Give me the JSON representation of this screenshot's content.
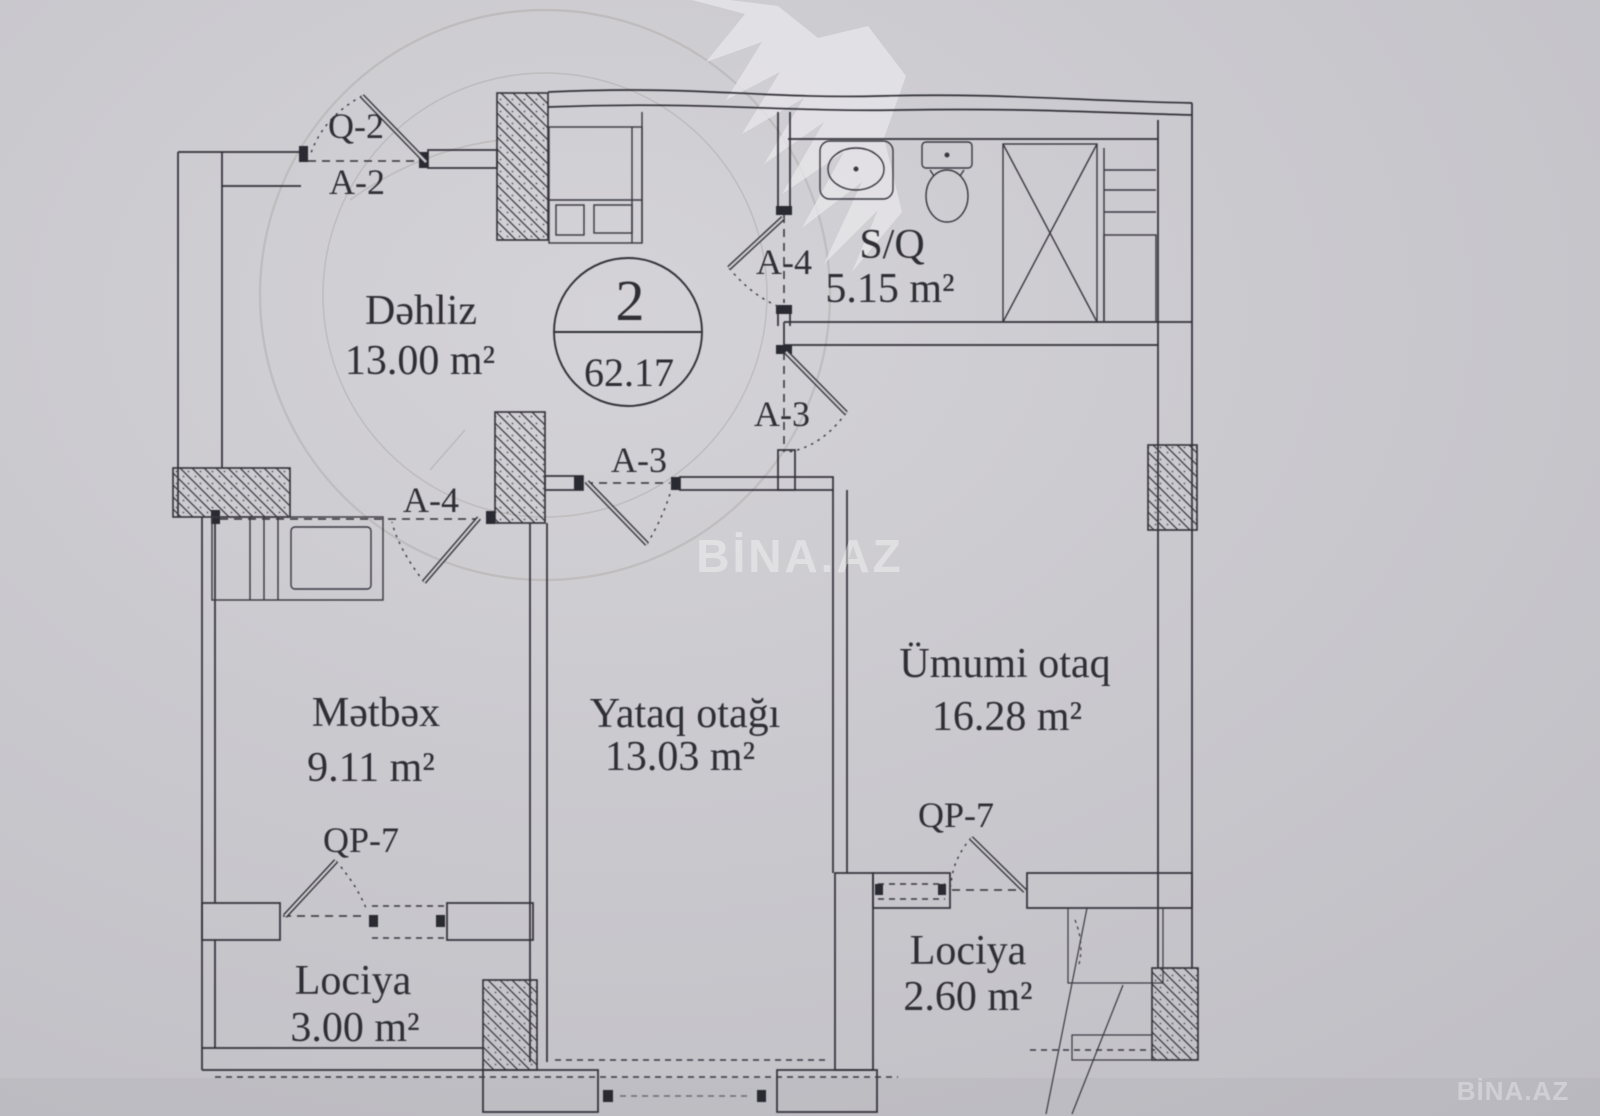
{
  "unit_badge": {
    "number": "2",
    "total_area": "62.17"
  },
  "rooms": {
    "dehliz": {
      "name": "Dəhliz",
      "area": "13.00 m²"
    },
    "sq": {
      "name": "S/Q",
      "area": "5.15 m²"
    },
    "metbex": {
      "name": "Mətbəx",
      "area": "9.11 m²"
    },
    "yataq": {
      "name": "Yataq otağı",
      "area": "13.03 m²"
    },
    "umumi": {
      "name": "Ümumi otaq",
      "area": "16.28 m²"
    },
    "lociya_left": {
      "name": "Lociya",
      "area": "3.00 m²"
    },
    "lociya_right": {
      "name": "Lociya",
      "area": "2.60 m²"
    }
  },
  "door_labels": {
    "entrance_top": "Q-2",
    "entrance": "A-2",
    "bathroom": "A-4",
    "living": "A-3",
    "bedroom": "A-3",
    "kitchen": "A-4",
    "balcony_left": "QP-7",
    "balcony_right": "QP-7"
  },
  "watermark": {
    "center": "BİNA.AZ",
    "corner": "BİNA.AZ"
  },
  "palette": {
    "paper": "#cac9ce",
    "ink": "#323138",
    "stamp": "#8a8175"
  }
}
